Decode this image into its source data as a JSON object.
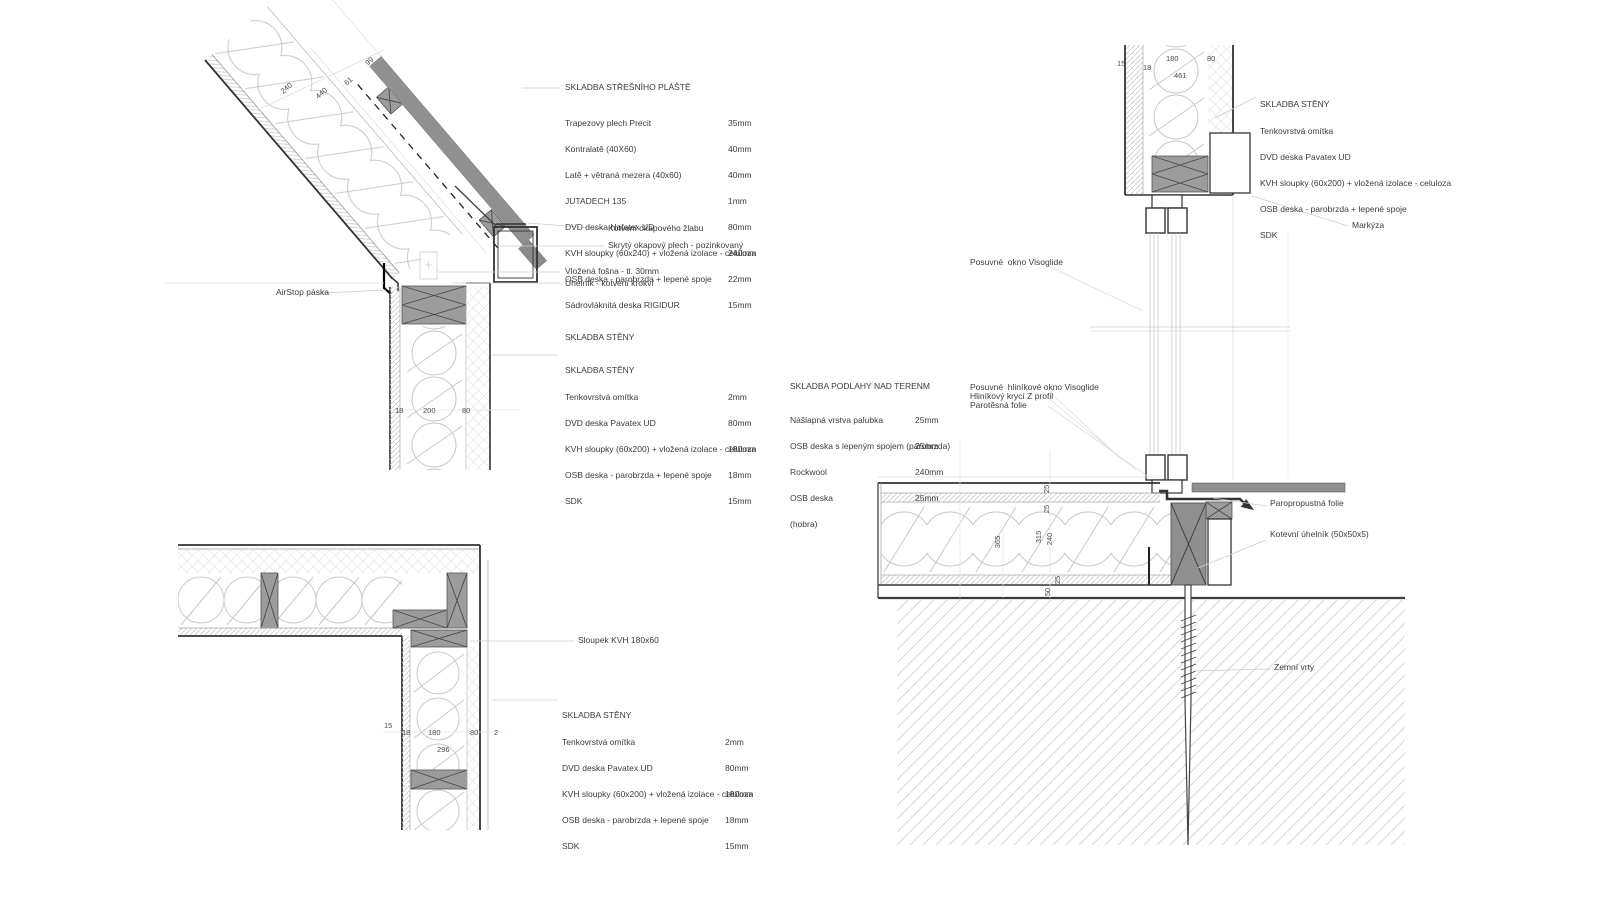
{
  "roof_assembly": {
    "title": "SKLADBA STŘEŠNÍHO PLÁŠTĚ",
    "items": [
      {
        "label": "Trapezovy plech Precit",
        "value": "35mm"
      },
      {
        "label": "Kontralatě (40X60)",
        "value": "40mm"
      },
      {
        "label": "Latě + větraná mezera (40x60)",
        "value": "40mm"
      },
      {
        "label": "JUTADECH 135",
        "value": "1mm"
      },
      {
        "label": "DVD deska Hafatex UD",
        "value": "80mm"
      },
      {
        "label": "KVH sloupky (60x240) + vložená izolace - celuloza",
        "value": "240mm"
      },
      {
        "label": "OSB deska - parobrzda + lepené spoje",
        "value": "22mm"
      },
      {
        "label": "Sádrovláknitá deska RIGIDUR",
        "value": "15mm"
      }
    ]
  },
  "wall_heading": "SKLADBA STĚNY",
  "wall_assembly": {
    "title": "SKLADBA STĚNY",
    "items": [
      {
        "label": "Tenkovrstvá omítka",
        "value": "2mm"
      },
      {
        "label": "DVD deska Pavatex UD",
        "value": "80mm"
      },
      {
        "label": "KVH sloupky (60x200) + vložená izolace - celuloza",
        "value": "180mm"
      },
      {
        "label": "OSB deska - parobrzda + lepené spoje",
        "value": "18mm"
      },
      {
        "label": "SDK",
        "value": "15mm"
      }
    ]
  },
  "wall_assembly_right": {
    "title": "SKLADBA STĚNY",
    "items": [
      "Tenkovrstvá omítka",
      "DVD deska Pavatex UD",
      "KVH sloupky (60x200) + vložená izolace - celuloza",
      "OSB deska - parobrzda + lepené spoje",
      "SDK"
    ]
  },
  "floor_assembly": {
    "title": "SKLADBA PODLAHY NAD TERENM",
    "items": [
      {
        "label": "Nášlapná vrstva palubka",
        "value": "25mm"
      },
      {
        "label": "OSB deska s lepeným spojem (parobrzda)",
        "value": "25mm"
      },
      {
        "label": "Rockwool",
        "value": "240mm"
      },
      {
        "label": "OSB deska",
        "value": "25mm"
      },
      {
        "label": "(hobra)",
        "value": ""
      }
    ]
  },
  "annotations": {
    "gutter_anchor": "Kotvení okapového žlabu",
    "hidden_flashing": "Skrytý okapový plech - pozinkovaný",
    "inserted_plank": "Vložená fošna - tl. 30mm",
    "angle_bracket": "Úhelník - kotvení krokví",
    "airstop": "AirStop páska",
    "post": "Sloupek KVH 180x60",
    "sliding_window": "Posuvné  okno Visoglide",
    "sliding_alu_window": "Posuvné  hliníkové okno Visoglide",
    "alu_z_profile": "Hliníkový krycí Z profil",
    "vapour_barrier": "Parotěsná folie",
    "awning": "Markýza",
    "vapour_permeable_foil": "Paropropustná folie",
    "anchor_angle": "Kotevní úhelník (50x50x5)",
    "ground_screws": "Zemní vrty"
  },
  "dims": {
    "roof": [
      "240",
      "440",
      "61",
      "99"
    ],
    "eave_wall": [
      "18",
      "200",
      "80"
    ],
    "top_right": [
      "15",
      "18",
      "180",
      "80",
      "461"
    ],
    "corner": [
      "15",
      "18",
      "180",
      "80",
      "2",
      "296"
    ],
    "floor": [
      "25",
      "25",
      "365",
      "315",
      "240",
      "25",
      "50"
    ]
  },
  "colors": {
    "line": "#333333",
    "light_line": "#c8c8c8",
    "timber_fill": "#9c9c9c",
    "roof_sheet": "#909090",
    "text": "#3c3c3c"
  }
}
